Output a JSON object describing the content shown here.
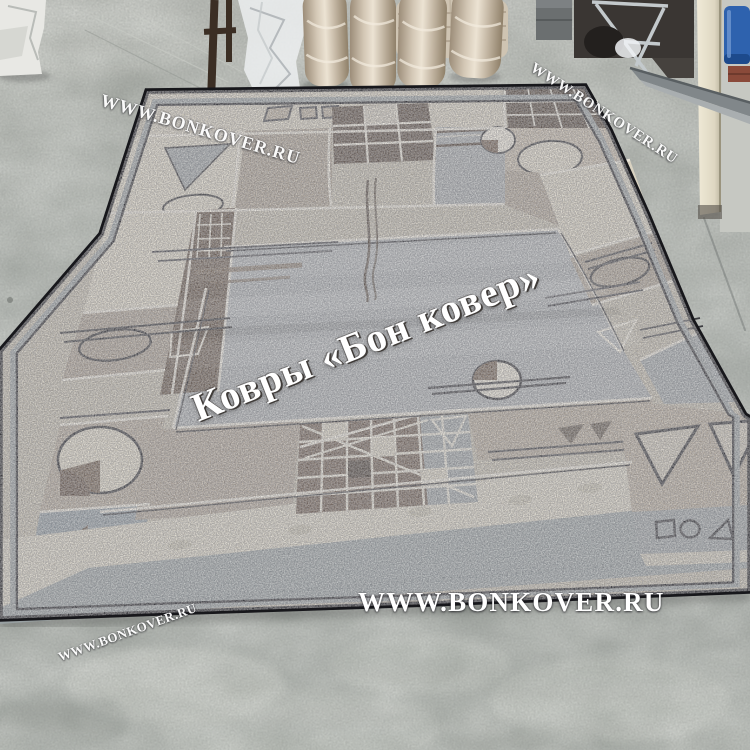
{
  "watermarks": {
    "top_left": "WWW.BONKOVER.RU",
    "top_right": "WWW.BONKOVER.RU",
    "center": "Ковры «Бон ковер»",
    "bottom": "WWW.BONKOVER.RU",
    "bottom_left": "WWW.BONKOVER.RU"
  },
  "colors": {
    "rug_field_gray": "#a9adb0",
    "rug_border_cream": "#d8d1c0",
    "rug_border_brown": "#5c4b3e",
    "rug_border_taupe": "#a89c8d",
    "rug_binding_gray": "#99a0a2",
    "rug_outline_black": "#17171b",
    "floor_gray": "#a4a8a2",
    "watermark_white": "#ffffff",
    "barrel_blue": "#2e62ae"
  }
}
